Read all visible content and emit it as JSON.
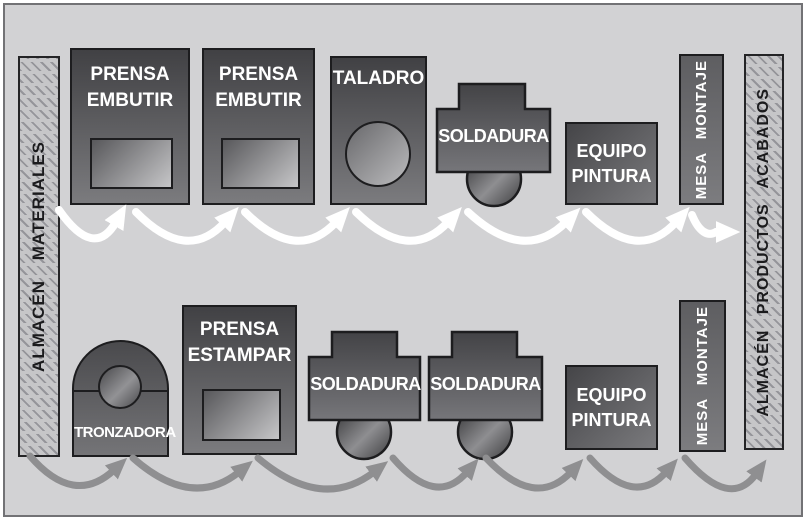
{
  "diagram": {
    "title": "Distribución de planta orientada al producto",
    "zones": {
      "materials_store": {
        "label": "ALMACÉN  MATERIALES"
      },
      "finished_store": {
        "label": "ALMACÉN  PRODUCTOS  ACABADOS"
      }
    },
    "rows": {
      "top": {
        "flow_color": "#ffffff",
        "machines": [
          {
            "type": "press",
            "label": "PRENSA EMBUTIR"
          },
          {
            "type": "press",
            "label": "PRENSA EMBUTIR"
          },
          {
            "type": "drill",
            "label": "TALADRO"
          },
          {
            "type": "welder",
            "label": "SOLDADURA"
          },
          {
            "type": "paint",
            "label": "EQUIPO PINTURA"
          },
          {
            "type": "assembly",
            "label": "MESA MONTAJE"
          }
        ]
      },
      "bottom": {
        "flow_color": "#8f8f91",
        "machines": [
          {
            "type": "saw",
            "label": "TRONZADORA"
          },
          {
            "type": "press",
            "label": "PRENSA ESTAMPAR"
          },
          {
            "type": "welder",
            "label": "SOLDADURA"
          },
          {
            "type": "welder",
            "label": "SOLDADURA"
          },
          {
            "type": "paint",
            "label": "EQUIPO PINTURA"
          },
          {
            "type": "assembly",
            "label": "MESA MONTAJE"
          }
        ]
      }
    },
    "colors": {
      "background": "#d2d2d4",
      "machine_dark": "#414144",
      "machine_light": "#7b7b7e",
      "outline": "#1d1d1f",
      "hatch_bg": "#c6c6c8",
      "hatch_line": "#95959a",
      "top_flow": "#ffffff",
      "bottom_flow": "#8f8f91"
    }
  }
}
